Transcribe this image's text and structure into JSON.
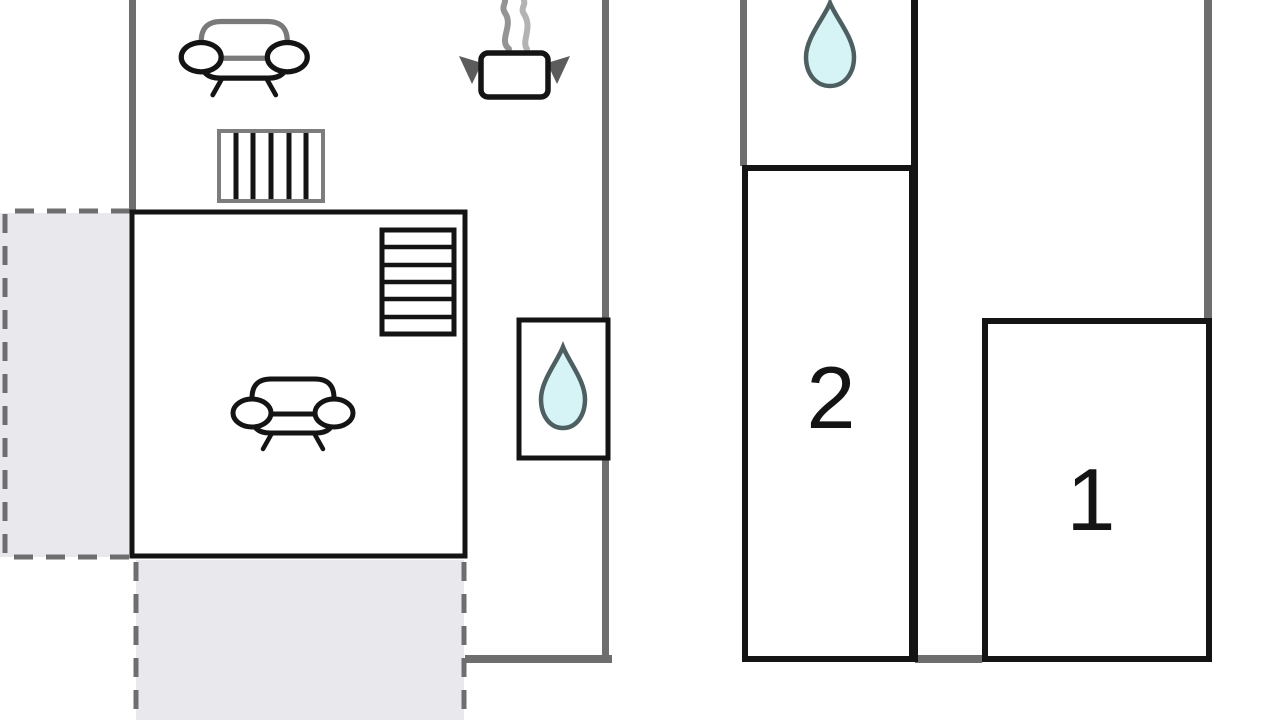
{
  "plan": {
    "canvas": {
      "width": 1280,
      "height": 720
    },
    "rooms": {
      "bedroom1": {
        "label": "1"
      },
      "bedroom2": {
        "label": "2"
      }
    },
    "icons": [
      {
        "name": "sofa-icon",
        "location": "upper-lounge"
      },
      {
        "name": "cooking-pot-icon",
        "location": "kitchen"
      },
      {
        "name": "steam-icon",
        "location": "kitchen"
      },
      {
        "name": "radiator-icon",
        "location": "upper-lounge"
      },
      {
        "name": "stairs-icon",
        "location": "living-room"
      },
      {
        "name": "sofa-icon",
        "location": "living-room"
      },
      {
        "name": "water-drop-icon",
        "location": "left-bathroom"
      },
      {
        "name": "water-drop-icon",
        "location": "right-bathroom"
      }
    ],
    "colors": {
      "wall_gray": "#6e6e6e",
      "outline_black": "#141414",
      "terrace_fill": "#e9e9ed",
      "terrace_dash": "#6e6e6e",
      "water_drop_fill": "#d6f4f6",
      "water_drop_stroke": "#4e5f62",
      "steam_dark": "#949494",
      "steam_light": "#b3b3b3",
      "radiator_frame": "#7d7d7d",
      "pot_handle": "#5c5c5c",
      "sofa_back_gray": "#7a7a7a"
    }
  }
}
